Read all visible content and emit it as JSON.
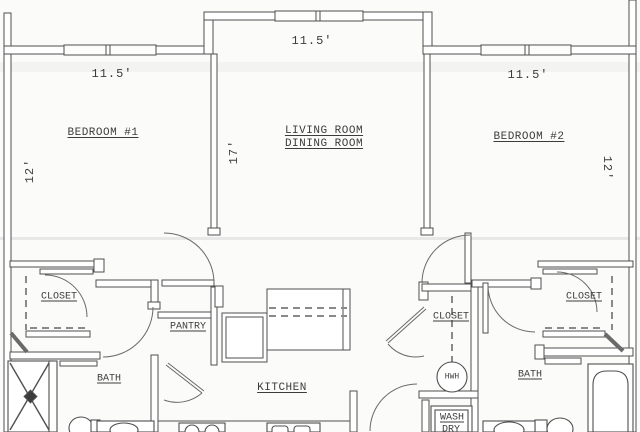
{
  "rooms": {
    "bedroom1": {
      "name": "BEDROOM #1",
      "width": "11.5'",
      "depth": "12'"
    },
    "living_dining": {
      "name_line1": "LIVING ROOM",
      "name_line2": "DINING ROOM",
      "width": "11.5'",
      "depth": "17'"
    },
    "bedroom2": {
      "name": "BEDROOM #2",
      "width": "11.5'",
      "depth": "12'"
    },
    "closet_bedroom1": {
      "name": "CLOSET"
    },
    "bath_left": {
      "name": "BATH"
    },
    "pantry": {
      "name": "PANTRY"
    },
    "kitchen": {
      "name": "KITCHEN"
    },
    "closet_hall": {
      "name": "CLOSET"
    },
    "closet_bedroom2": {
      "name": "CLOSET"
    },
    "bath_right": {
      "name": "BATH"
    }
  },
  "fixtures": {
    "water_heater": {
      "label": "HWH"
    },
    "laundry": {
      "line1": "WASH",
      "line2": "DRY"
    }
  },
  "colors": {
    "wall_line": "#4f4f4f",
    "arc_line": "#6a6a6a",
    "text": "#3c3c3c",
    "background": "#fbfbfa",
    "scan_band": "#d8d8d8"
  }
}
